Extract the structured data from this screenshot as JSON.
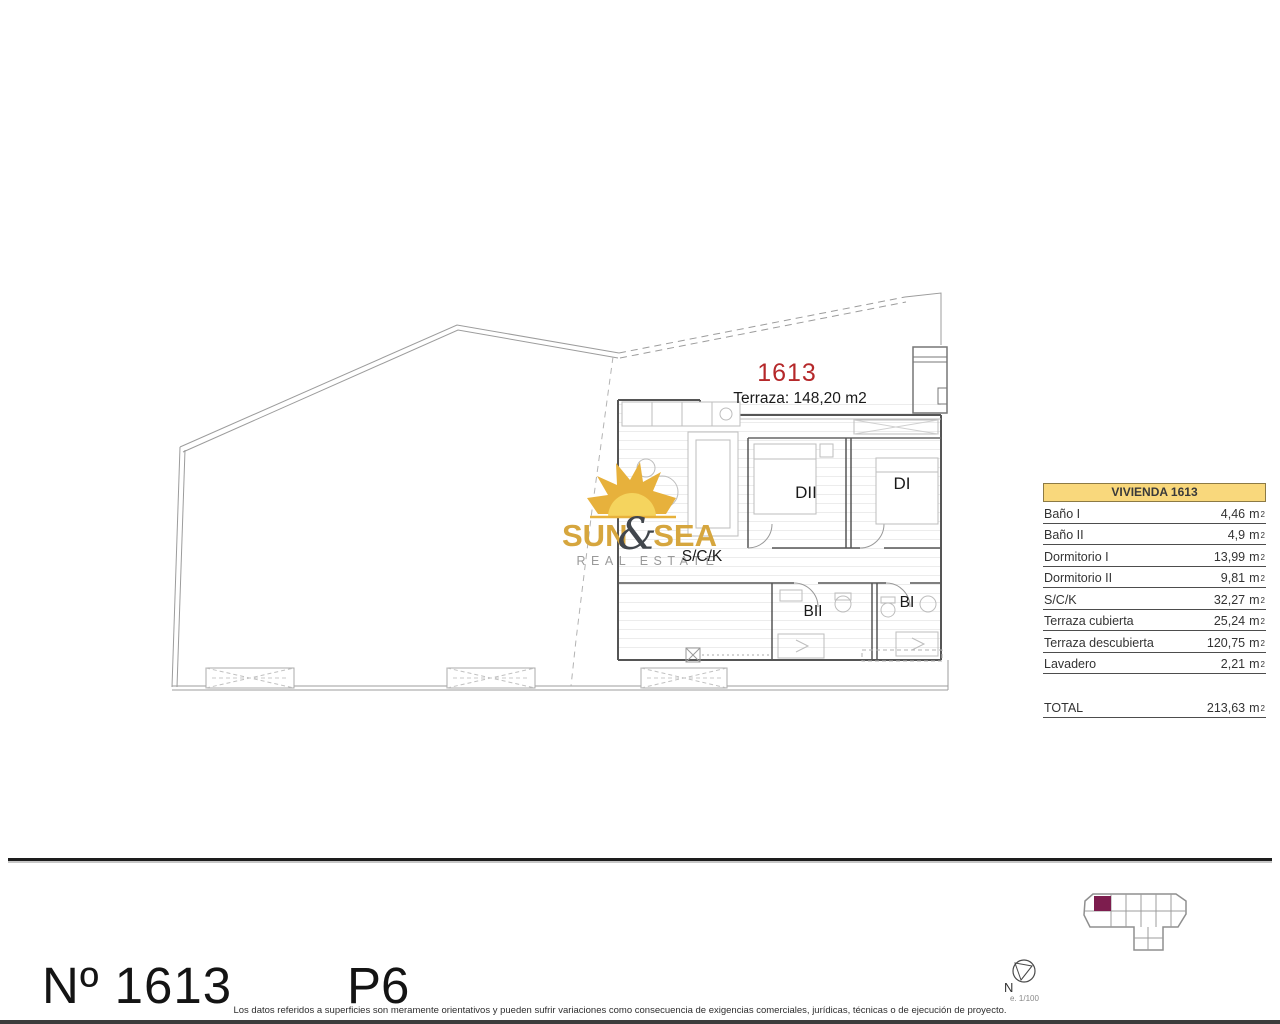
{
  "colors": {
    "unit_number_red": "#b5282a",
    "table_header_bg": "#f9d87c",
    "logo_gold": "#d6a63e",
    "logo_dark": "#41464c",
    "minimap_highlight": "#7d1d4e"
  },
  "plan": {
    "unit_number": "1613",
    "terrace_label": "Terraza: 148,20 m2",
    "rooms": {
      "dormitorio2": "DII",
      "dormitorio1": "DI",
      "salon": "S/C/K",
      "bano2": "BII",
      "bano1": "BI"
    }
  },
  "logo": {
    "word1": "SUN",
    "ampersand": "&",
    "word2": "SEA",
    "tagline": "REAL ESTATE"
  },
  "area_table": {
    "header": "VIVIENDA 1613",
    "unit": "m",
    "unit_sup": "2",
    "rows": [
      {
        "label": "Baño I",
        "value": "4,46"
      },
      {
        "label": "Baño II",
        "value": "4,9"
      },
      {
        "label": "Dormitorio I",
        "value": "13,99"
      },
      {
        "label": "Dormitorio II",
        "value": "9,81"
      },
      {
        "label": "S/C/K",
        "value": "32,27"
      },
      {
        "label": "Terraza cubierta",
        "value": "25,24"
      },
      {
        "label": "Terraza descubierta",
        "value": "120,75"
      },
      {
        "label": "Lavadero",
        "value": "2,21"
      }
    ],
    "total": {
      "label": "TOTAL",
      "value": "213,63"
    }
  },
  "footer": {
    "unit_ref": "Nº 1613",
    "floor": "P6",
    "disclaimer": "Los datos referidos a superficies son meramente orientativos y pueden sufrir variaciones como consecuencia de exigencias comerciales, jurídicas, técnicas o de ejecución de proyecto.",
    "compass_north": "N",
    "scale": "e. 1/100"
  }
}
